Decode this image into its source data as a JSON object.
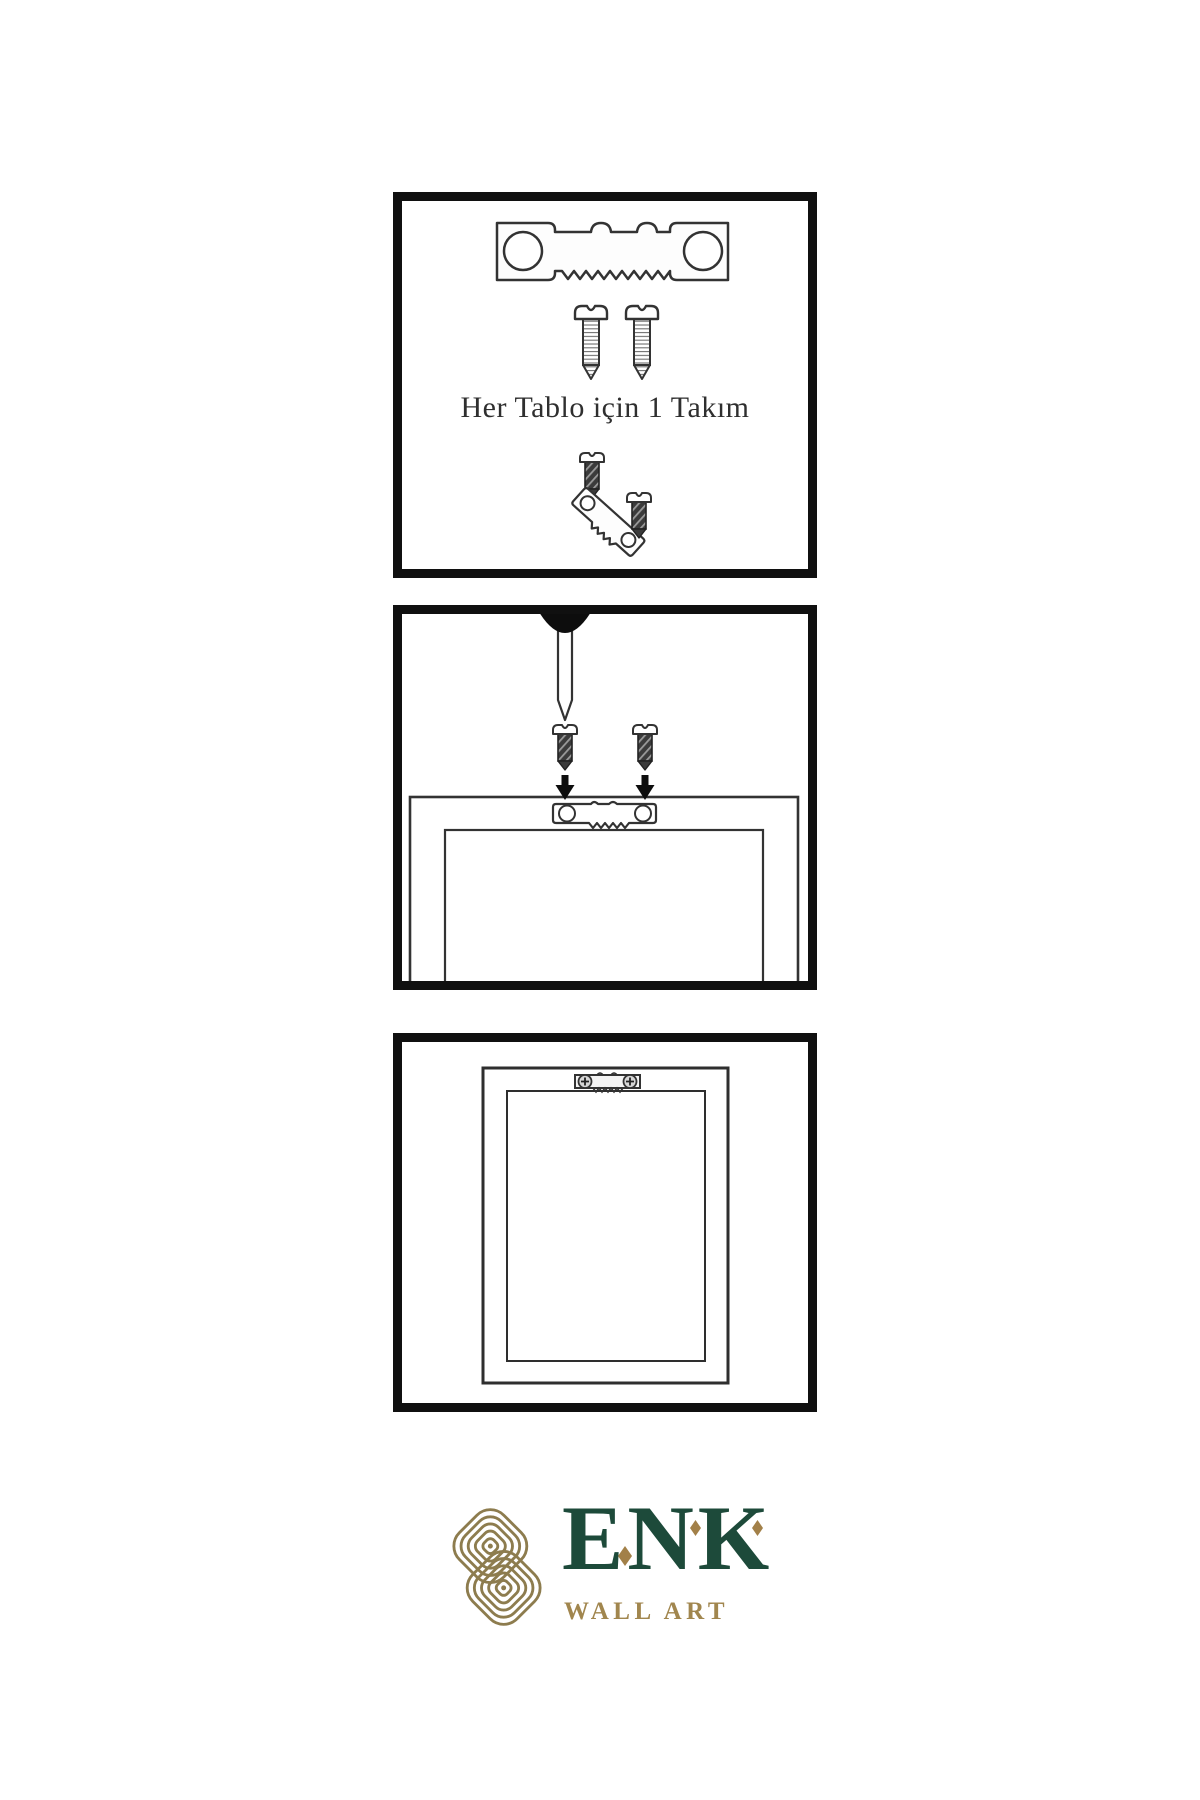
{
  "page": {
    "background": "#ffffff"
  },
  "panels": {
    "kit": {
      "caption": "Her Tablo için 1 Takım",
      "icons": [
        "sawtooth-hanger-icon",
        "screw-icon",
        "screw-icon",
        "dark-screw-icon",
        "tilted-sawtooth-hanger-icon",
        "dark-screw-icon"
      ]
    },
    "nailing": {
      "icons": [
        "wall-nail-icon",
        "dark-screw-icon",
        "dark-screw-icon",
        "down-arrow-icon",
        "down-arrow-icon",
        "frame-back-outline",
        "sawtooth-hanger-icon"
      ]
    },
    "hung": {
      "icons": [
        "frame-outline",
        "mounted-sawtooth-hanger-icon"
      ]
    }
  },
  "logo": {
    "brand": "ENK",
    "subtitle": "WALL ART",
    "icon": "knot-logo-icon",
    "colors": {
      "knot": "#8d7c4e",
      "brand_text": "#1d4a3a",
      "accent": "#a28048",
      "subtitle_text": "#a1864e"
    }
  },
  "colors": {
    "panel_border": "#101010",
    "line": "#333333",
    "dark_fill": "#3b3b3b"
  }
}
